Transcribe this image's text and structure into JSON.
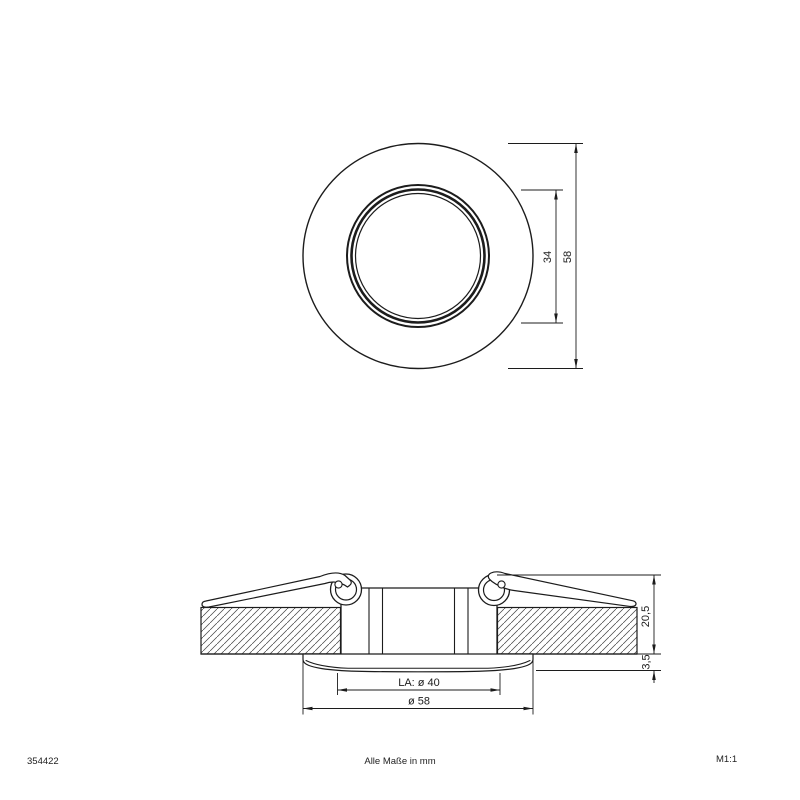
{
  "footer": {
    "article_number": "354422",
    "units_note": "Alle Maße in mm",
    "scale": "M1:1"
  },
  "top_view": {
    "dim_inner_diameter": "34",
    "dim_outer_diameter": "58"
  },
  "side_view": {
    "dim_recess_height": "20,5",
    "dim_rim_height": "3,5",
    "dim_cutout": "LA: ø 40",
    "dim_outer_diameter": "ø 58"
  },
  "colors": {
    "line": "#1c1c1c",
    "background": "#ffffff",
    "hatch": "#444444"
  }
}
